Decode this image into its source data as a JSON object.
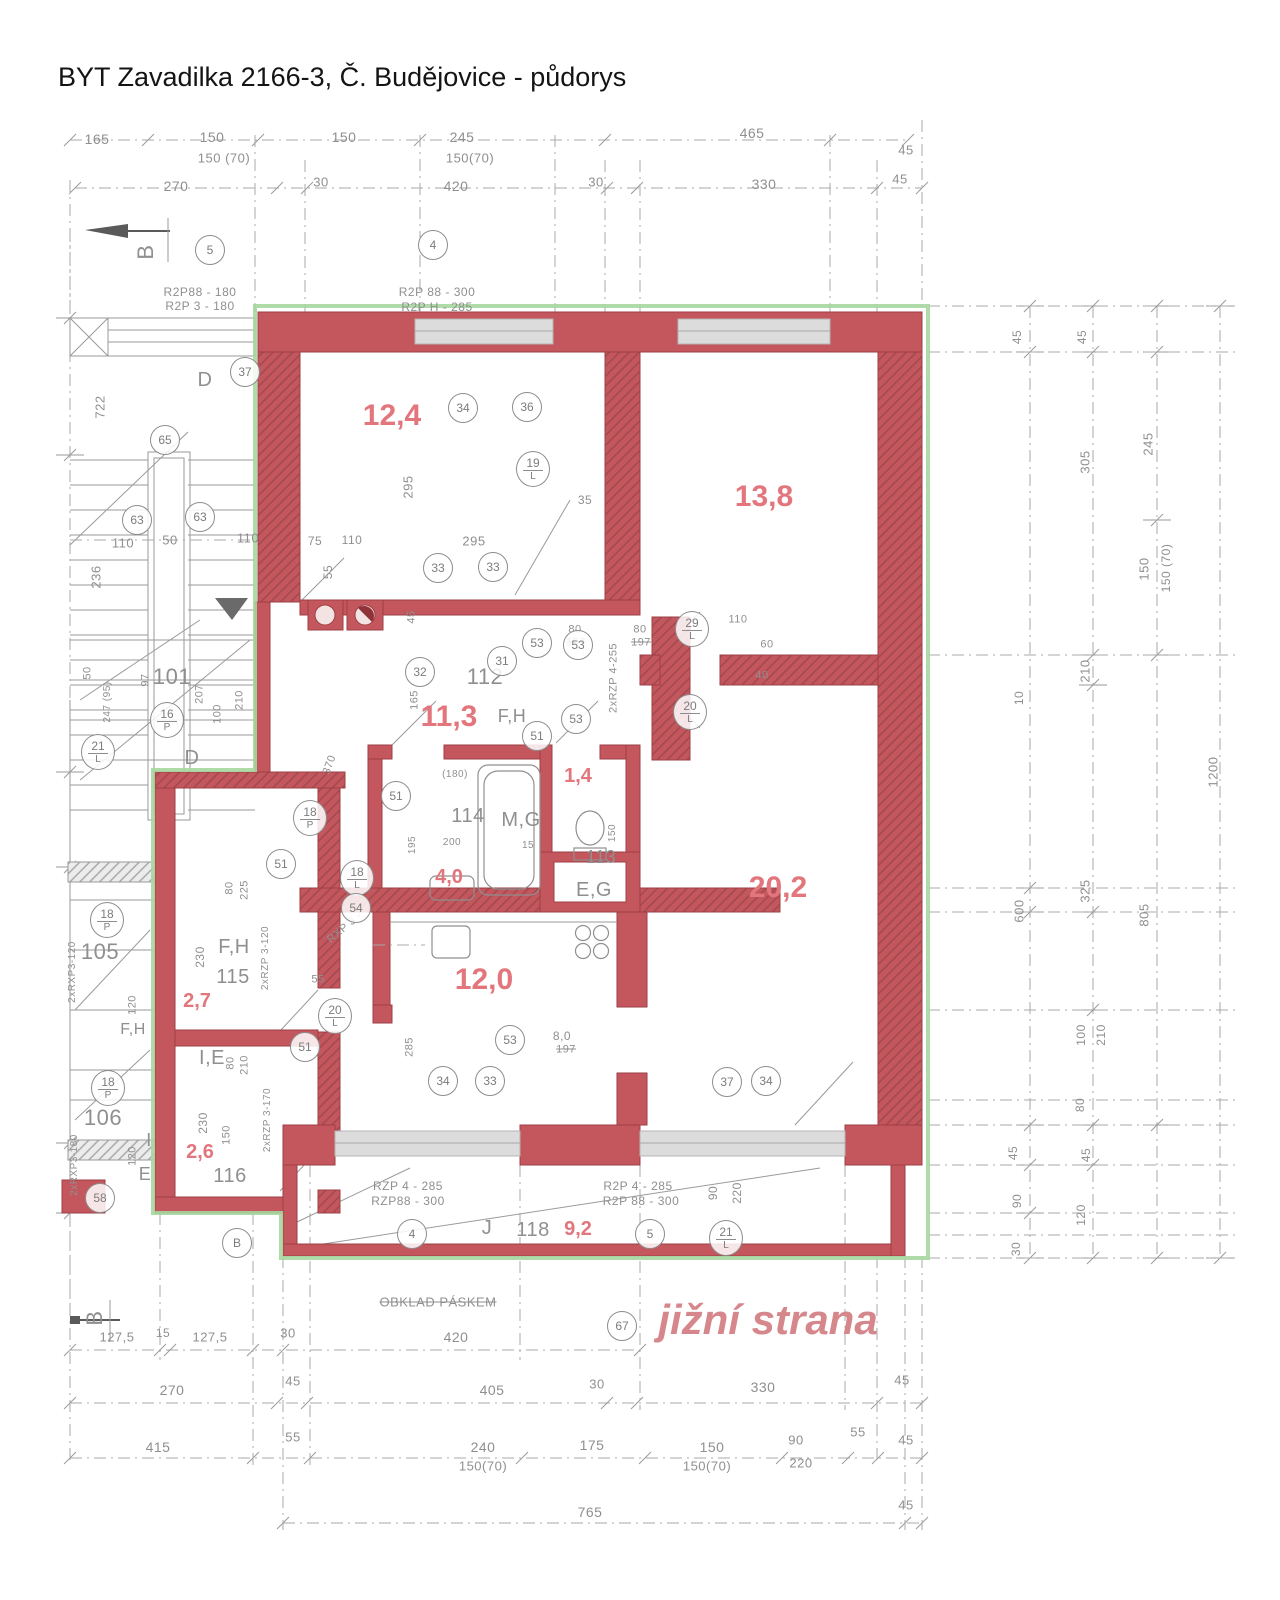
{
  "title": "BYT Zavadilka 2166-3, Č. Budějovice - půdorys",
  "footer": {
    "t": "jižní strana",
    "x": 768,
    "y": 1320,
    "s": 42
  },
  "colors": {
    "wall": "#c4575d",
    "wall_dark": "#9e3f45",
    "outline_green": "#a6d79f",
    "pencil": "#8f8f8f",
    "area_text": "#e2767c",
    "window": "#dcdcdc"
  },
  "room_areas": [
    {
      "v": "12,4",
      "x": 392,
      "y": 416,
      "s": 30
    },
    {
      "v": "13,8",
      "x": 764,
      "y": 497,
      "s": 30
    },
    {
      "v": "11,3",
      "x": 449,
      "y": 717,
      "s": 30
    },
    {
      "v": "1,4",
      "x": 578,
      "y": 776,
      "s": 20
    },
    {
      "v": "4,0",
      "x": 449,
      "y": 877,
      "s": 20
    },
    {
      "v": "20,2",
      "x": 778,
      "y": 888,
      "s": 30
    },
    {
      "v": "12,0",
      "x": 484,
      "y": 980,
      "s": 30
    },
    {
      "v": "2,7",
      "x": 197,
      "y": 1001,
      "s": 20
    },
    {
      "v": "2,6",
      "x": 200,
      "y": 1152,
      "s": 20
    },
    {
      "v": "9,2",
      "x": 578,
      "y": 1229,
      "s": 20
    }
  ],
  "texts": [
    {
      "t": "165",
      "x": 97,
      "y": 139
    },
    {
      "t": "150",
      "x": 212,
      "y": 137
    },
    {
      "t": "150 (70)",
      "x": 224,
      "y": 158,
      "s": 13
    },
    {
      "t": "150",
      "x": 344,
      "y": 137
    },
    {
      "t": "245",
      "x": 462,
      "y": 137
    },
    {
      "t": "150(70)",
      "x": 470,
      "y": 158,
      "s": 13
    },
    {
      "t": "465",
      "x": 752,
      "y": 133
    },
    {
      "t": "45",
      "x": 906,
      "y": 150,
      "s": 13
    },
    {
      "t": "270",
      "x": 176,
      "y": 186
    },
    {
      "t": "30",
      "x": 321,
      "y": 182,
      "s": 13
    },
    {
      "t": "420",
      "x": 456,
      "y": 186
    },
    {
      "t": "30",
      "x": 596,
      "y": 182,
      "s": 13
    },
    {
      "t": "330",
      "x": 764,
      "y": 184
    },
    {
      "t": "45",
      "x": 900,
      "y": 179,
      "s": 13
    },
    {
      "t": "B",
      "x": 146,
      "y": 252,
      "s": 22,
      "r": -90
    },
    {
      "t": "B",
      "x": 95,
      "y": 1318,
      "s": 22,
      "r": -90
    },
    {
      "t": "R2P88 - 180",
      "x": 200,
      "y": 292,
      "s": 12
    },
    {
      "t": "R2P 3 - 180",
      "x": 200,
      "y": 306,
      "s": 12
    },
    {
      "t": "R2P 88 - 300",
      "x": 437,
      "y": 292,
      "s": 12
    },
    {
      "t": "R2P H - 285",
      "x": 437,
      "y": 307,
      "s": 12
    },
    {
      "t": "D",
      "x": 205,
      "y": 380,
      "s": 20
    },
    {
      "t": "D",
      "x": 192,
      "y": 758,
      "s": 20
    },
    {
      "t": "722",
      "x": 100,
      "y": 407,
      "s": 13,
      "r": -90
    },
    {
      "t": "236",
      "x": 96,
      "y": 577,
      "s": 13,
      "r": -90
    },
    {
      "t": "110",
      "x": 123,
      "y": 543,
      "s": 13
    },
    {
      "t": "50",
      "x": 170,
      "y": 540,
      "s": 13
    },
    {
      "t": "110",
      "x": 248,
      "y": 538,
      "s": 13
    },
    {
      "t": "101",
      "x": 172,
      "y": 677,
      "s": 22
    },
    {
      "t": "50",
      "x": 88,
      "y": 673,
      "s": 11,
      "r": -90
    },
    {
      "t": "247 (95)",
      "x": 108,
      "y": 702,
      "s": 10,
      "r": -90
    },
    {
      "t": "97",
      "x": 146,
      "y": 680,
      "s": 11,
      "r": -90
    },
    {
      "t": "207",
      "x": 200,
      "y": 694,
      "s": 11,
      "r": -90
    },
    {
      "t": "210",
      "x": 240,
      "y": 700,
      "s": 11,
      "r": -90
    },
    {
      "t": "100",
      "x": 218,
      "y": 714,
      "s": 11,
      "r": -90
    },
    {
      "t": "295",
      "x": 408,
      "y": 487,
      "s": 13,
      "r": -90
    },
    {
      "t": "75",
      "x": 315,
      "y": 541,
      "s": 12
    },
    {
      "t": "110",
      "x": 352,
      "y": 540,
      "s": 12
    },
    {
      "t": "295",
      "x": 474,
      "y": 541,
      "s": 13
    },
    {
      "t": "35",
      "x": 585,
      "y": 500,
      "s": 12
    },
    {
      "t": "55",
      "x": 328,
      "y": 572,
      "s": 12,
      "r": -90
    },
    {
      "t": "45",
      "x": 412,
      "y": 617,
      "s": 11,
      "r": -90
    },
    {
      "t": "112",
      "x": 485,
      "y": 677,
      "s": 22
    },
    {
      "t": "F,H",
      "x": 512,
      "y": 716,
      "s": 18
    },
    {
      "t": "165",
      "x": 415,
      "y": 700,
      "s": 11,
      "r": -90
    },
    {
      "t": "370",
      "x": 330,
      "y": 765,
      "s": 11,
      "r": -70
    },
    {
      "t": "80",
      "x": 575,
      "y": 630,
      "s": 11
    },
    {
      "t": "197",
      "x": 576,
      "y": 643,
      "s": 11,
      "st": 1
    },
    {
      "t": "80",
      "x": 640,
      "y": 630,
      "s": 11
    },
    {
      "t": "197",
      "x": 641,
      "y": 643,
      "s": 11,
      "st": 1
    },
    {
      "t": "2xRZP 4-255",
      "x": 614,
      "y": 678,
      "s": 11,
      "r": -90
    },
    {
      "t": "110",
      "x": 738,
      "y": 620,
      "s": 11
    },
    {
      "t": "60",
      "x": 767,
      "y": 645,
      "s": 11
    },
    {
      "t": "40",
      "x": 762,
      "y": 676,
      "s": 11
    },
    {
      "t": "114",
      "x": 468,
      "y": 816,
      "s": 20
    },
    {
      "t": "M,G",
      "x": 521,
      "y": 820,
      "s": 20
    },
    {
      "t": "113",
      "x": 601,
      "y": 857,
      "s": 18
    },
    {
      "t": "E,G",
      "x": 594,
      "y": 890,
      "s": 20
    },
    {
      "t": "(180)",
      "x": 455,
      "y": 775,
      "s": 10
    },
    {
      "t": "200",
      "x": 452,
      "y": 843,
      "s": 10
    },
    {
      "t": "15",
      "x": 528,
      "y": 846,
      "s": 10
    },
    {
      "t": "195",
      "x": 413,
      "y": 845,
      "s": 10,
      "r": -90
    },
    {
      "t": "150",
      "x": 613,
      "y": 833,
      "s": 10,
      "r": -90
    },
    {
      "t": "F,H",
      "x": 234,
      "y": 947,
      "s": 20
    },
    {
      "t": "115",
      "x": 233,
      "y": 977,
      "s": 20
    },
    {
      "t": "I,E",
      "x": 212,
      "y": 1058,
      "s": 20
    },
    {
      "t": "116",
      "x": 230,
      "y": 1176,
      "s": 20
    },
    {
      "t": "105",
      "x": 100,
      "y": 952,
      "s": 22
    },
    {
      "t": "F,H",
      "x": 133,
      "y": 1030,
      "s": 16
    },
    {
      "t": "106",
      "x": 103,
      "y": 1118,
      "s": 22
    },
    {
      "t": "I",
      "x": 149,
      "y": 1140,
      "s": 18
    },
    {
      "t": "E",
      "x": 145,
      "y": 1174,
      "s": 18
    },
    {
      "t": "230",
      "x": 200,
      "y": 957,
      "s": 12,
      "r": -90
    },
    {
      "t": "225",
      "x": 245,
      "y": 890,
      "s": 11,
      "r": -90
    },
    {
      "t": "80",
      "x": 230,
      "y": 888,
      "s": 11,
      "r": -90
    },
    {
      "t": "230",
      "x": 203,
      "y": 1123,
      "s": 12,
      "r": -90
    },
    {
      "t": "210",
      "x": 245,
      "y": 1065,
      "s": 11,
      "r": -90
    },
    {
      "t": "80",
      "x": 231,
      "y": 1063,
      "s": 11,
      "r": -90
    },
    {
      "t": "150",
      "x": 227,
      "y": 1135,
      "s": 11,
      "r": -90
    },
    {
      "t": "120",
      "x": 133,
      "y": 1005,
      "s": 11,
      "r": -90
    },
    {
      "t": "120",
      "x": 133,
      "y": 1156,
      "s": 11,
      "r": -90
    },
    {
      "t": "2xRZP 3-120",
      "x": 266,
      "y": 958,
      "s": 10,
      "r": -90
    },
    {
      "t": "2xRZP 3-170",
      "x": 268,
      "y": 1120,
      "s": 10,
      "r": -90
    },
    {
      "t": "2xRXP3-120",
      "x": 73,
      "y": 972,
      "s": 10,
      "r": -90
    },
    {
      "t": "2xRXP3-180",
      "x": 75,
      "y": 1165,
      "s": 10,
      "r": -90
    },
    {
      "t": "RXP 3 -",
      "x": 345,
      "y": 928,
      "s": 11,
      "r": -40
    },
    {
      "t": "55",
      "x": 318,
      "y": 980,
      "s": 11
    },
    {
      "t": "8,0",
      "x": 562,
      "y": 1036,
      "s": 12
    },
    {
      "t": "197",
      "x": 566,
      "y": 1050,
      "s": 11,
      "st": 1
    },
    {
      "t": "285",
      "x": 410,
      "y": 1047,
      "s": 11,
      "r": -90
    },
    {
      "t": "J",
      "x": 487,
      "y": 1228,
      "s": 20
    },
    {
      "t": "118",
      "x": 533,
      "y": 1230,
      "s": 20
    },
    {
      "t": "RZP 4 - 285",
      "x": 408,
      "y": 1186,
      "s": 12
    },
    {
      "t": "RZP88 - 300",
      "x": 408,
      "y": 1201,
      "s": 12
    },
    {
      "t": "R2P 4 - 285",
      "x": 638,
      "y": 1186,
      "s": 12
    },
    {
      "t": "R2P 88 - 300",
      "x": 641,
      "y": 1201,
      "s": 12
    },
    {
      "t": "90",
      "x": 713,
      "y": 1193,
      "s": 12,
      "r": -90
    },
    {
      "t": "220",
      "x": 737,
      "y": 1193,
      "s": 12,
      "r": -90
    },
    {
      "t": "OBKLAD PÁSKEM",
      "x": 438,
      "y": 1302,
      "s": 13,
      "st": 1
    },
    {
      "t": "127,5",
      "x": 117,
      "y": 1337,
      "s": 13
    },
    {
      "t": "15",
      "x": 163,
      "y": 1333,
      "s": 12
    },
    {
      "t": "127,5",
      "x": 210,
      "y": 1337,
      "s": 13
    },
    {
      "t": "30",
      "x": 288,
      "y": 1333,
      "s": 13
    },
    {
      "t": "420",
      "x": 456,
      "y": 1337
    },
    {
      "t": "270",
      "x": 172,
      "y": 1390
    },
    {
      "t": "45",
      "x": 293,
      "y": 1381,
      "s": 13
    },
    {
      "t": "405",
      "x": 492,
      "y": 1390
    },
    {
      "t": "30",
      "x": 597,
      "y": 1384,
      "s": 13
    },
    {
      "t": "330",
      "x": 763,
      "y": 1387
    },
    {
      "t": "45",
      "x": 902,
      "y": 1380,
      "s": 13
    },
    {
      "t": "415",
      "x": 158,
      "y": 1447
    },
    {
      "t": "55",
      "x": 293,
      "y": 1437,
      "s": 13
    },
    {
      "t": "240",
      "x": 483,
      "y": 1447
    },
    {
      "t": "150(70)",
      "x": 483,
      "y": 1466,
      "s": 13
    },
    {
      "t": "175",
      "x": 592,
      "y": 1445
    },
    {
      "t": "150",
      "x": 712,
      "y": 1447
    },
    {
      "t": "150(70)",
      "x": 707,
      "y": 1466,
      "s": 13
    },
    {
      "t": "90",
      "x": 796,
      "y": 1440,
      "s": 13
    },
    {
      "t": "220",
      "x": 801,
      "y": 1463,
      "s": 13
    },
    {
      "t": "55",
      "x": 858,
      "y": 1432,
      "s": 13
    },
    {
      "t": "45",
      "x": 906,
      "y": 1440,
      "s": 13
    },
    {
      "t": "765",
      "x": 590,
      "y": 1512
    },
    {
      "t": "45",
      "x": 906,
      "y": 1505,
      "s": 13
    },
    {
      "t": "45",
      "x": 1017,
      "y": 337,
      "s": 12,
      "r": -90
    },
    {
      "t": "45",
      "x": 1082,
      "y": 337,
      "s": 12,
      "r": -90
    },
    {
      "t": "305",
      "x": 1085,
      "y": 462,
      "s": 13,
      "r": -90
    },
    {
      "t": "245",
      "x": 1148,
      "y": 444,
      "s": 13,
      "r": -90
    },
    {
      "t": "150",
      "x": 1144,
      "y": 569,
      "s": 13,
      "r": -90
    },
    {
      "t": "150 (70)",
      "x": 1166,
      "y": 568,
      "s": 12,
      "r": -90
    },
    {
      "t": "210",
      "x": 1085,
      "y": 671,
      "s": 13,
      "r": -90
    },
    {
      "t": "10",
      "x": 1019,
      "y": 698,
      "s": 12,
      "r": -90
    },
    {
      "t": "600",
      "x": 1019,
      "y": 911,
      "s": 13,
      "r": -90
    },
    {
      "t": "325",
      "x": 1085,
      "y": 891,
      "s": 13,
      "r": -90
    },
    {
      "t": "805",
      "x": 1144,
      "y": 915,
      "s": 13,
      "r": -90
    },
    {
      "t": "1200",
      "x": 1213,
      "y": 772,
      "s": 13,
      "r": -90
    },
    {
      "t": "100",
      "x": 1081,
      "y": 1035,
      "s": 12,
      "r": -90
    },
    {
      "t": "210",
      "x": 1101,
      "y": 1035,
      "s": 12,
      "r": -90
    },
    {
      "t": "80",
      "x": 1080,
      "y": 1105,
      "s": 12,
      "r": -90
    },
    {
      "t": "45",
      "x": 1013,
      "y": 1153,
      "s": 12,
      "r": -90
    },
    {
      "t": "45",
      "x": 1086,
      "y": 1155,
      "s": 12,
      "r": -90
    },
    {
      "t": "90",
      "x": 1017,
      "y": 1201,
      "s": 12,
      "r": -90
    },
    {
      "t": "120",
      "x": 1081,
      "y": 1215,
      "s": 12,
      "r": -90
    },
    {
      "t": "30",
      "x": 1016,
      "y": 1249,
      "s": 12,
      "r": -90
    }
  ],
  "circles": [
    {
      "x": 210,
      "y": 250,
      "t": "5"
    },
    {
      "x": 433,
      "y": 245,
      "t": "4"
    },
    {
      "x": 245,
      "y": 372,
      "t": "37"
    },
    {
      "x": 165,
      "y": 440,
      "t": "65"
    },
    {
      "x": 137,
      "y": 520,
      "t": "63"
    },
    {
      "x": 200,
      "y": 517,
      "t": "63"
    },
    {
      "x": 463,
      "y": 408,
      "t": "34"
    },
    {
      "x": 527,
      "y": 407,
      "t": "36"
    },
    {
      "x": 533,
      "y": 469,
      "t": "19",
      "b": "L"
    },
    {
      "x": 438,
      "y": 568,
      "t": "33"
    },
    {
      "x": 493,
      "y": 567,
      "t": "33"
    },
    {
      "x": 420,
      "y": 672,
      "t": "32"
    },
    {
      "x": 502,
      "y": 661,
      "t": "31"
    },
    {
      "x": 537,
      "y": 643,
      "t": "53"
    },
    {
      "x": 578,
      "y": 645,
      "t": "53"
    },
    {
      "x": 537,
      "y": 736,
      "t": "51"
    },
    {
      "x": 576,
      "y": 719,
      "t": "53"
    },
    {
      "x": 692,
      "y": 629,
      "t": "29",
      "b": "L"
    },
    {
      "x": 690,
      "y": 712,
      "t": "20",
      "b": "L"
    },
    {
      "x": 98,
      "y": 752,
      "t": "21",
      "b": "L"
    },
    {
      "x": 167,
      "y": 720,
      "t": "16",
      "b": "P"
    },
    {
      "x": 310,
      "y": 818,
      "t": "18",
      "b": "P"
    },
    {
      "x": 281,
      "y": 864,
      "t": "51"
    },
    {
      "x": 396,
      "y": 796,
      "t": "51"
    },
    {
      "x": 107,
      "y": 920,
      "t": "18",
      "b": "P"
    },
    {
      "x": 108,
      "y": 1088,
      "t": "18",
      "b": "P"
    },
    {
      "x": 100,
      "y": 1198,
      "t": "58"
    },
    {
      "x": 357,
      "y": 878,
      "t": "18",
      "b": "L"
    },
    {
      "x": 356,
      "y": 908,
      "t": "54"
    },
    {
      "x": 335,
      "y": 1016,
      "t": "20",
      "b": "L"
    },
    {
      "x": 305,
      "y": 1047,
      "t": "51"
    },
    {
      "x": 510,
      "y": 1040,
      "t": "53"
    },
    {
      "x": 443,
      "y": 1081,
      "t": "34"
    },
    {
      "x": 490,
      "y": 1081,
      "t": "33"
    },
    {
      "x": 727,
      "y": 1082,
      "t": "37"
    },
    {
      "x": 766,
      "y": 1081,
      "t": "34"
    },
    {
      "x": 412,
      "y": 1234,
      "t": "4"
    },
    {
      "x": 650,
      "y": 1234,
      "t": "5"
    },
    {
      "x": 726,
      "y": 1238,
      "t": "21",
      "b": "L"
    },
    {
      "x": 622,
      "y": 1326,
      "t": "67"
    },
    {
      "x": 237,
      "y": 1243,
      "t": "B"
    }
  ]
}
